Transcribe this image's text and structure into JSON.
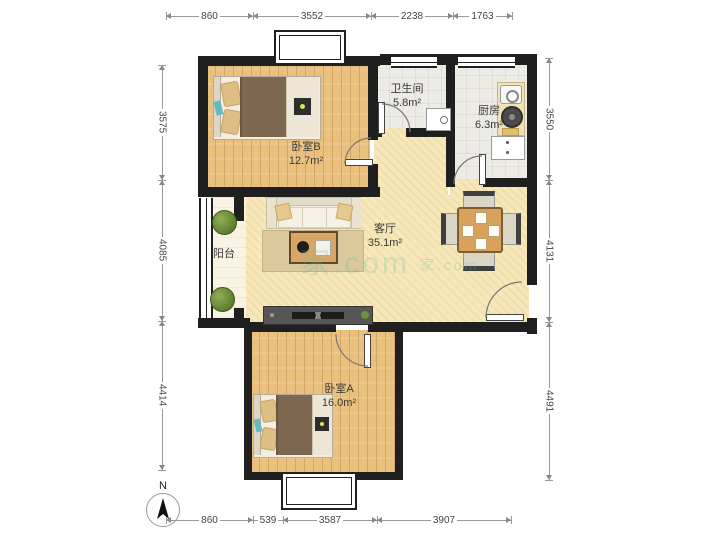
{
  "rooms": {
    "bedroom_b": {
      "name": "卧室B",
      "area": "12.7m²"
    },
    "bathroom": {
      "name": "卫生间",
      "area": "5.8m²"
    },
    "kitchen": {
      "name": "厨房",
      "area": "6.3m²"
    },
    "living_room": {
      "name": "客厅",
      "area": "35.1m²"
    },
    "balcony": {
      "name": "阳台"
    },
    "bedroom_a": {
      "name": "卧室A",
      "area": "16.0m²"
    }
  },
  "dimensions": {
    "top": [
      "860",
      "3552",
      "2238",
      "1763"
    ],
    "bottom": [
      "860",
      "539",
      "3587",
      "3907"
    ],
    "left": [
      "3575",
      "4085",
      "4414"
    ],
    "right": [
      "3550",
      "4131",
      "4491"
    ]
  },
  "compass": {
    "label": "N"
  },
  "watermark": {
    "text": "家.com"
  },
  "colors": {
    "wall": "#1f1f1f",
    "wood_floor": "#EAC07E",
    "living_floor": "#F6E8BA",
    "tile_floor": "#EDEBE6",
    "balcony_floor": "#F8F3E3",
    "plant_green": "#6F923D",
    "duvet_brown": "#7E6751",
    "dim_text": "#444444"
  }
}
